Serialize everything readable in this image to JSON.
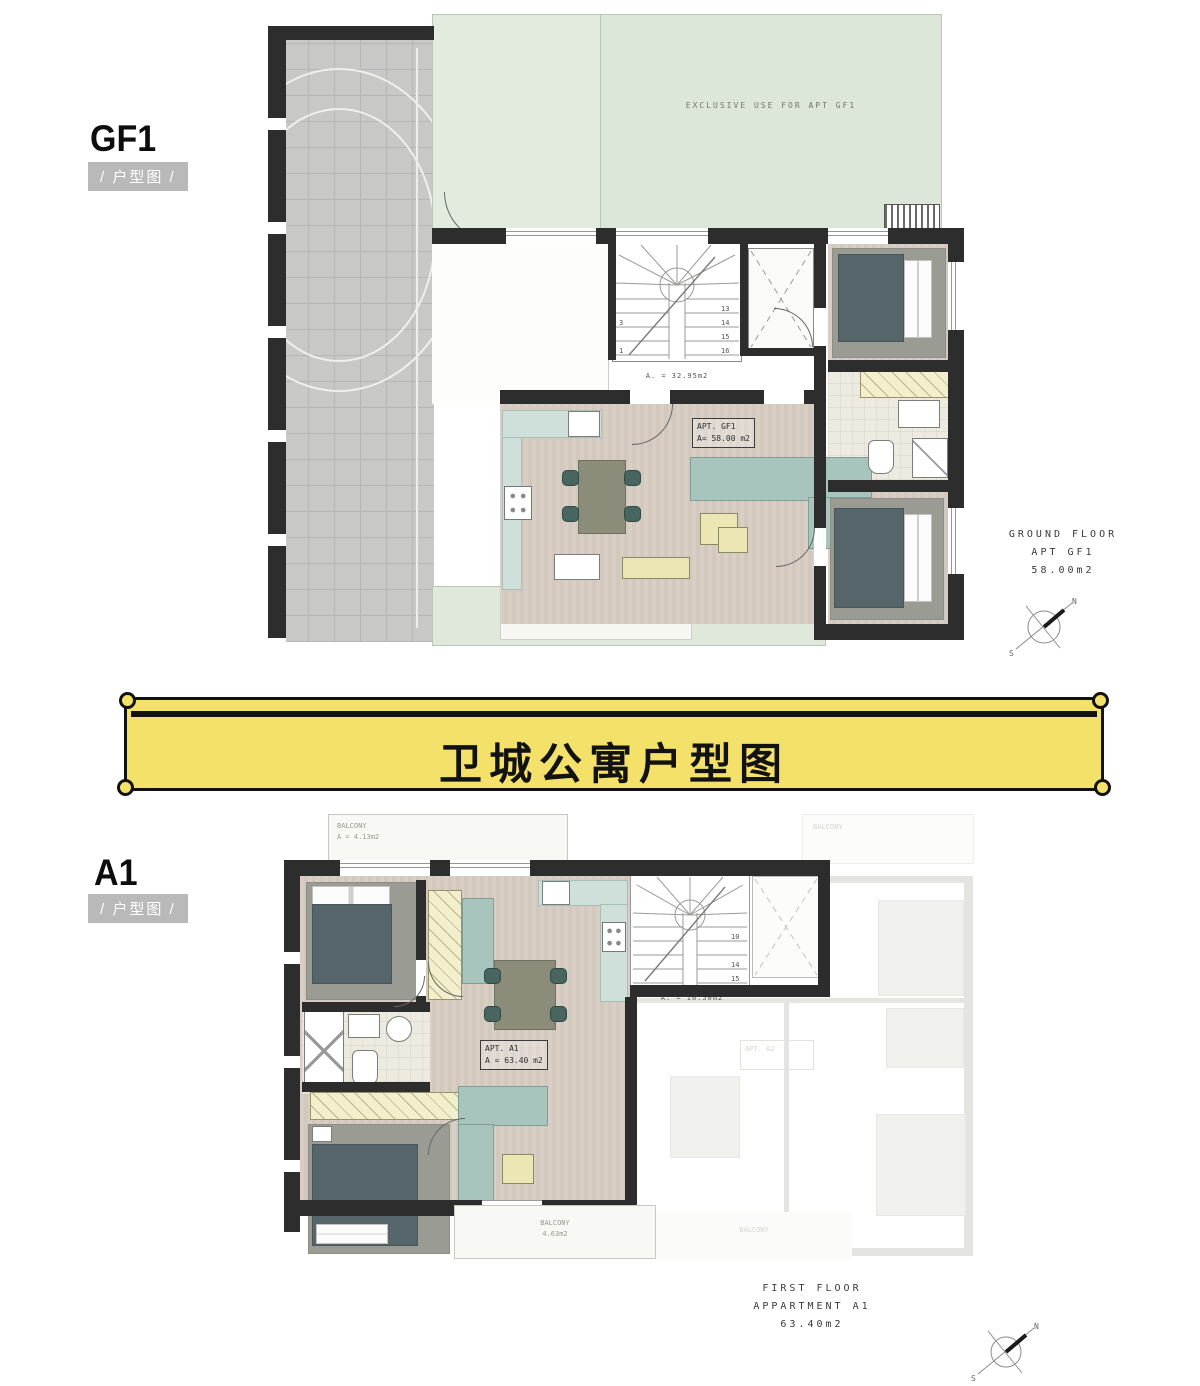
{
  "banner": {
    "title": "卫城公寓户型图",
    "bg": "#f3e16a",
    "border": "#121212"
  },
  "gf1": {
    "code": "GF1",
    "tag": "/ 户型图 /",
    "garden_note": "EXCLUSIVE USE FOR APT GF1",
    "apt_label": {
      "line1": "APT. GF1",
      "line2": "A= 58.00 m2"
    },
    "stair_area": "A. = 32.95m2",
    "steps": [
      "1",
      "2",
      "3",
      "4",
      "5",
      "6",
      "7",
      "8",
      "9",
      "10",
      "11",
      "12",
      "13",
      "14",
      "15",
      "16"
    ],
    "caption": {
      "line1": "GROUND FLOOR",
      "line2": "APT GF1",
      "line3": "58.00m2"
    },
    "compass": {
      "n": "N",
      "s": "S"
    }
  },
  "a1": {
    "code": "A1",
    "tag": "/ 户型图 /",
    "balcony_top": {
      "name": "BALCONY",
      "area": "A = 4.13m2"
    },
    "apt_label": {
      "line1": "APT. A1",
      "line2": "A = 63.40 m2"
    },
    "stair_area": "A. = 16.50m2",
    "steps": [
      "1",
      "2",
      "3",
      "4",
      "5",
      "6",
      "7",
      "8",
      "9",
      "10",
      "11",
      "12",
      "13",
      "14",
      "15",
      "16"
    ],
    "balcony_bottom": {
      "name": "BALCONY",
      "area": "4.63m2"
    },
    "ghost": {
      "apt": "APT. A2",
      "balcony_top": "BALCONY",
      "balcony_bottom": "BALCONY"
    },
    "caption": {
      "line1": "FIRST FLOOR",
      "line2": "APPARTMENT A1",
      "line3": "63.40m2"
    },
    "compass": {
      "n": "N",
      "s": "S"
    }
  },
  "colors": {
    "wall": "#2d2d2d",
    "wood": "#d5cbc1",
    "kitchen": "#cfe0da",
    "sofa": "#a7c5bd",
    "garden": "#dfe8db",
    "paving": "#c8c8c6",
    "banner_yellow": "#f3e16a",
    "wardrobe": "#f3eecb",
    "duvet": "#57666b",
    "rug": "#9a9b92"
  }
}
